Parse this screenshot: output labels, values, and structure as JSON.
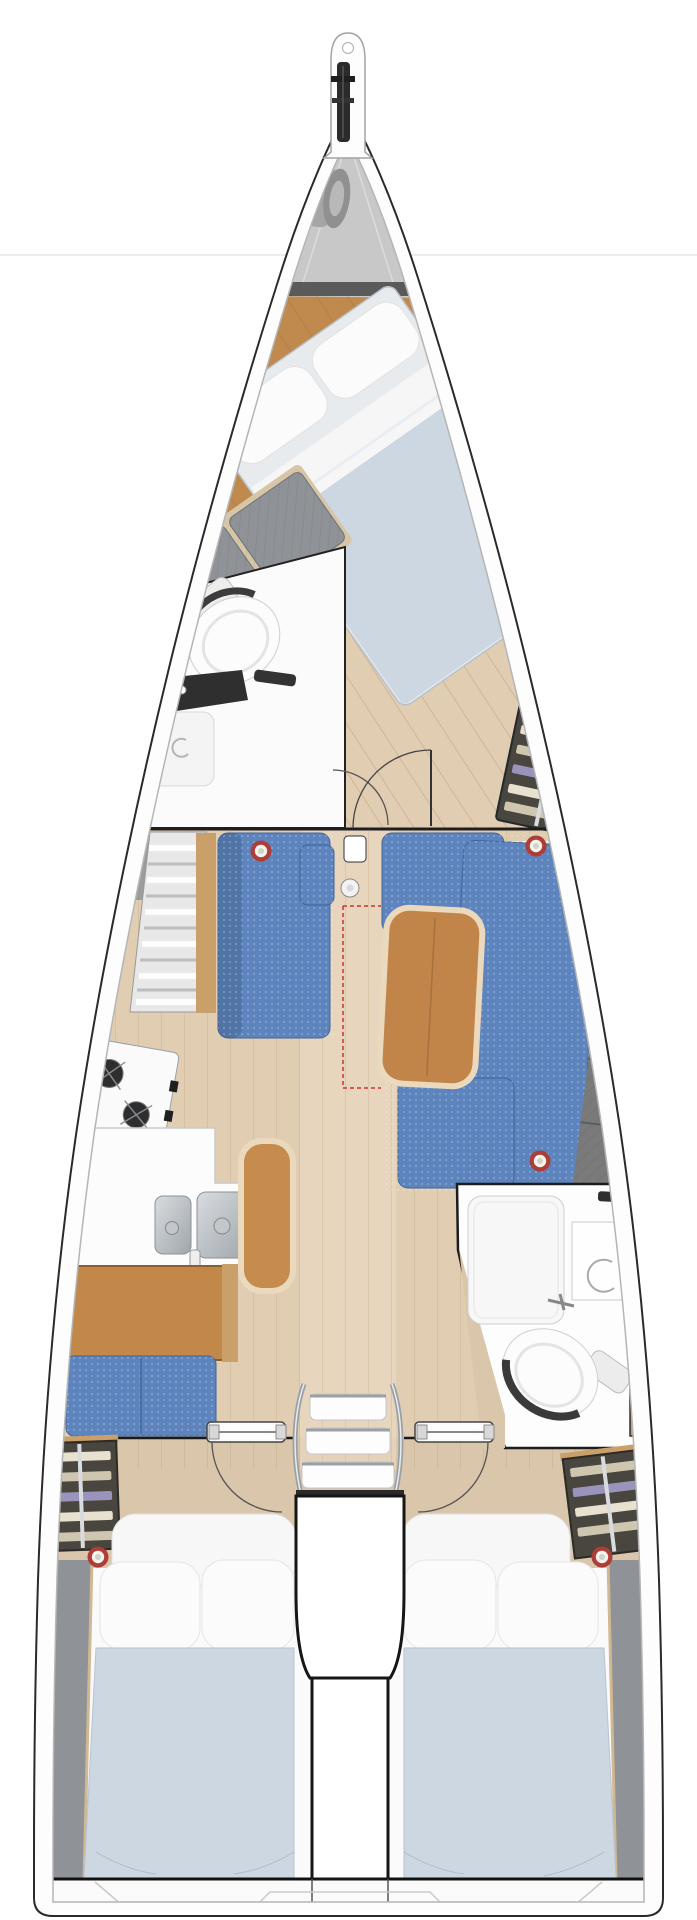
{
  "diagram": {
    "type": "boat-interior-floor-plan",
    "orientation": "bow-up",
    "rooms": [
      "anchor-locker",
      "fore-cabin",
      "fore-head",
      "saloon",
      "galley",
      "nav-station",
      "aft-head",
      "companionway",
      "engine-compartment",
      "aft-cabin-port",
      "aft-cabin-starboard",
      "stern-platform"
    ],
    "furniture": [
      "bow-sprit",
      "anchor-roller",
      "fender-bag",
      "double-berth-fore",
      "wardrobe-shelves-fore",
      "toilet-fore",
      "shower-fore",
      "vanity-fore",
      "settee-port",
      "settee-starboard",
      "saloon-table",
      "mast-post",
      "stove",
      "galley-counter",
      "double-sink",
      "galley-bench",
      "chart-desk",
      "nav-seat",
      "wardrobe-port-aft",
      "wardrobe-starboard-aft",
      "toilet-aft",
      "shower-aft",
      "vanity-aft",
      "companionway-steps",
      "cabin-door-port",
      "cabin-door-starboard",
      "double-berth-port-aft",
      "double-berth-starboard-aft"
    ],
    "markers": {
      "red_ring_count": 5
    }
  },
  "palette": {
    "background": "#ffffff",
    "page_line": "#ececec",
    "hull_fill": "#fdfdfd",
    "hull_stroke": "#2a2a2a",
    "gunwale_line": "#b5b5b5",
    "inner_line": "#3a3a3a",
    "locker_gray": "#c8c8c8",
    "fender_gray": "#a5a5a5",
    "band_dark": "#5a5a5a",
    "wood_orange": "#c08a4e",
    "floor_tan": "#e0cdb2",
    "floor_tan_aft": "#d9c6ab",
    "walkway_light": "#ecdcc6",
    "mattress": "#ccd7e2",
    "pillow": "#fbfbfb",
    "sheet_white": "#f6f6f6",
    "sofa_blue": "#5d84bd",
    "sofa_edge": "#41659c",
    "table_wood": "#c1854a",
    "table_rim": "#ead9bd",
    "bench_wood": "#c68c4d",
    "desk_wood": "#c2884a",
    "gray_cushion": "#8f9296",
    "backrest_gray": "#7a7a7a",
    "hull_band_gray": "#707070",
    "locker_dark": "#49453f",
    "clothes_beige": "#e8e1cf",
    "clothes_tan": "#cfc6b0",
    "clothes_lavender": "#9a94bd",
    "steel_light": "#d9dcdf",
    "steel_dark": "#9fa6ac",
    "burner_dark": "#2e2e2e",
    "chrome": "#9aa0a5",
    "fixture_white": "#fcfcfc",
    "stove_white": "#fafafa",
    "red_marker": "#ad3d37",
    "marker_center": "#cfd4c4",
    "window_blue": "#b9c6dc",
    "wood_trim": "#c9a06a",
    "door_wood": "#c6995e",
    "dashed_red": "#cc3333",
    "dark_panel": "#3b3b3b",
    "engine_outline": "#161616"
  }
}
